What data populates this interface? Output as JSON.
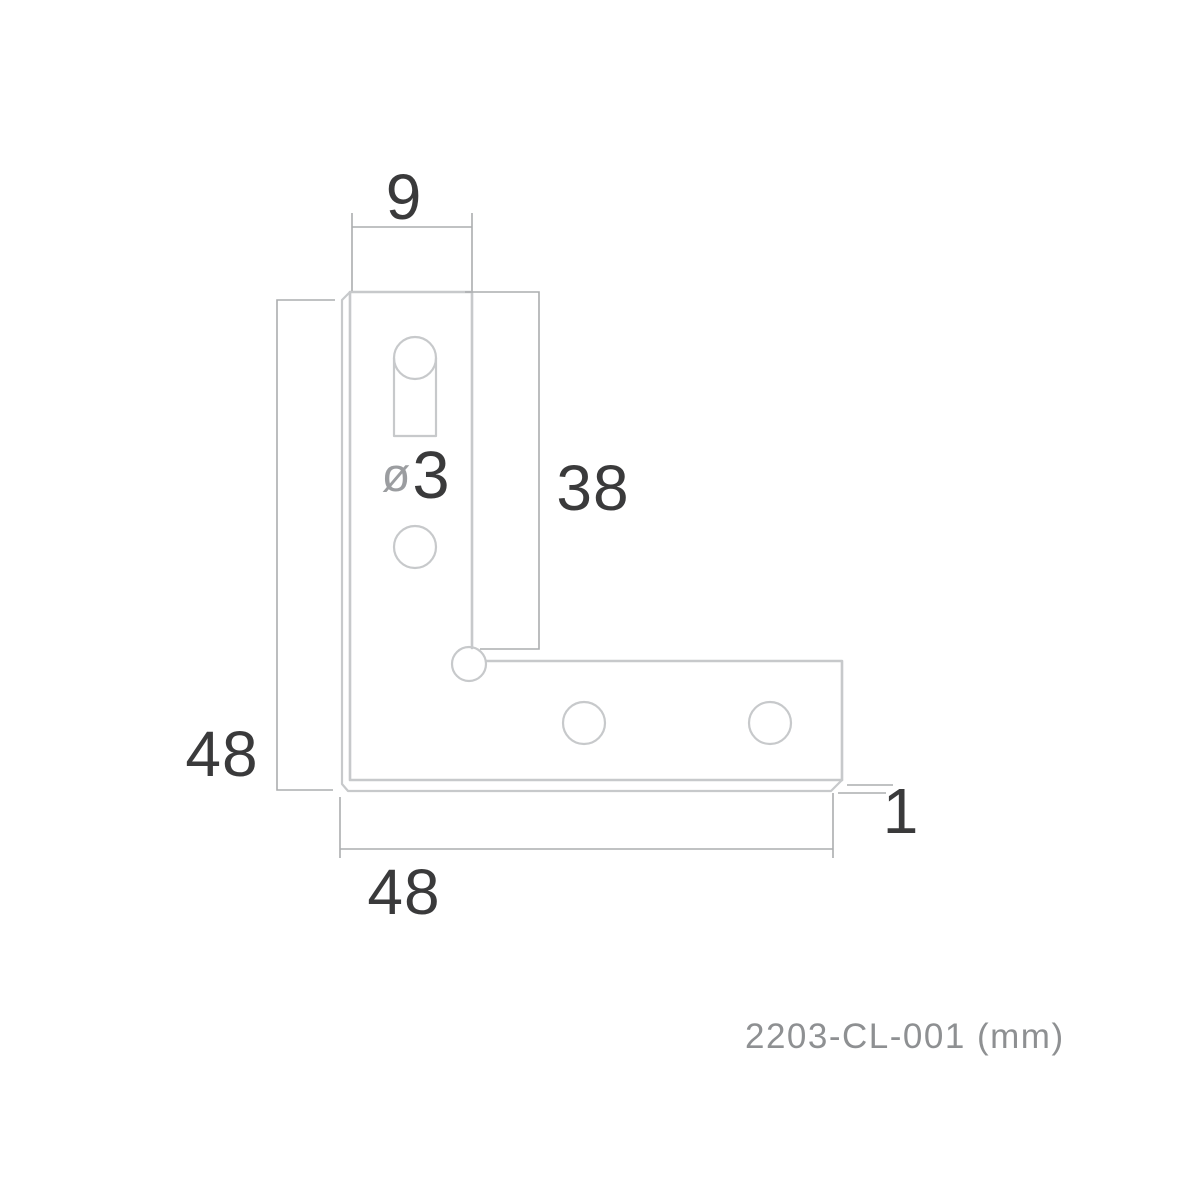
{
  "drawing": {
    "title": "corner-bracket-dimension-drawing",
    "footer": {
      "part_number": "2203-CL-001",
      "units": "(mm)"
    },
    "dimensions": {
      "arm_width": "9",
      "inner_edge_length": "38",
      "outer_height": "48",
      "outer_width": "48",
      "thickness": "1",
      "hole_diameter_symbol": "ø",
      "hole_diameter_value": "3"
    },
    "colors": {
      "background": "#ffffff",
      "part_outline": "#c7c9cb",
      "dimension_line": "#abadaf",
      "dimension_text": "#3a3a3b",
      "diameter_symbol": "#9b9da0",
      "footer_text": "#8e9092"
    }
  }
}
